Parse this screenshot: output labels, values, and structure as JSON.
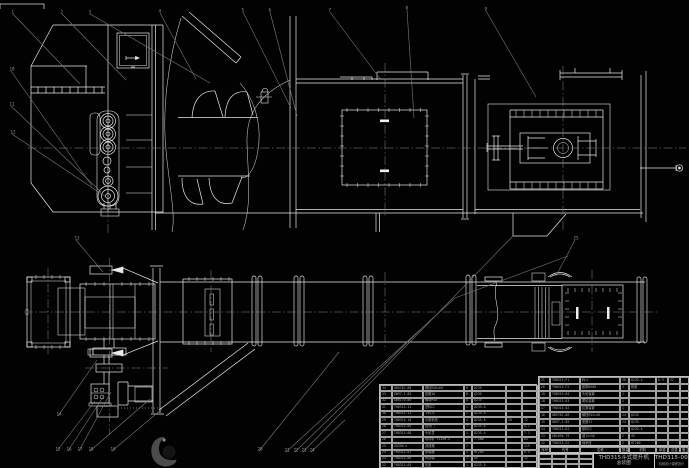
{
  "meta": {
    "background": "#020202",
    "line_color": "#e8e8e8",
    "leader_color": "#7a7a7a",
    "table_text_color": "#a9a9a9"
  },
  "title_block": {
    "product": "THD315斗式提升机",
    "sheet_name": "总装图",
    "drawing_no": "THD315-00",
    "org": "机械设计课程设计"
  },
  "bom_headers": [
    "序号",
    "代号",
    "名称",
    "数量",
    "材料",
    "单重",
    "总重",
    "备注"
  ],
  "right_bom_rows": [
    [
      "21",
      "THD315-F1",
      "料斗",
      "36",
      "Q235-A",
      "0.9",
      "32",
      ""
    ],
    [
      "20",
      "THD315-F2",
      "胶带B500",
      "1",
      "橡胶",
      "",
      "",
      ""
    ],
    [
      "19",
      "THD315-04",
      "头轮装置",
      "1",
      "",
      "",
      "",
      ""
    ],
    [
      "18",
      "THD315-03",
      "尾轮装置",
      "1",
      "",
      "",
      "",
      ""
    ],
    [
      "17",
      "THD315-02",
      "拉紧装置",
      "1",
      "",
      "",
      "",
      ""
    ],
    [
      "16",
      "GB5782-86",
      "螺栓M12×40",
      "24",
      "Q235",
      "",
      "",
      ""
    ],
    [
      "15",
      "GB97.1-85",
      "垫圈12",
      "24",
      "Q235",
      "",
      "",
      ""
    ],
    [
      "14",
      "THD315-01",
      "卸料口",
      "1",
      "Q235-A",
      "",
      "",
      ""
    ],
    [
      "13",
      "GB1096-79",
      "键12×56",
      "2",
      "45",
      "",
      "",
      ""
    ],
    [
      "12",
      "THD315-G2",
      "轴承座",
      "2",
      "HT200",
      "",
      "",
      ""
    ]
  ],
  "left_bom_rows": [
    [
      "34",
      "GB5782-86",
      "螺栓M16×60",
      "8",
      "Q235",
      "",
      ""
    ],
    [
      "33",
      "GB97.1-85",
      "垫圈16",
      "8",
      "Q235",
      "",
      ""
    ],
    [
      "32",
      "GB6170-86",
      "螺母M16",
      "8",
      "Q235",
      "",
      ""
    ],
    [
      "31",
      "THD315-12",
      "进料口",
      "1",
      "Q235-A",
      "",
      ""
    ],
    [
      "30",
      "THD315-11",
      "下料斗",
      "1",
      "Q235-A",
      "",
      ""
    ],
    [
      "29",
      "THD315-10",
      "中部机壳",
      "4",
      "Q235-A",
      "18",
      "72"
    ],
    [
      "28",
      "THD315-09",
      "检视门",
      "1",
      "Q235-A",
      "",
      "4.1"
    ],
    [
      "27",
      "THD315-08",
      "头轮罩",
      "1",
      "Q235-A",
      "",
      "7.2"
    ],
    [
      "26",
      "",
      "电动机 Y132M-4",
      "1",
      "7.5kW",
      "",
      "63"
    ],
    [
      "25",
      "ZQ350-Ⅱ",
      "减速器",
      "1",
      "",
      "",
      "115"
    ],
    [
      "24",
      "THD315-07",
      "联轴器",
      "1",
      "HT200",
      "",
      "6.4"
    ],
    [
      "23",
      "THD315-06",
      "传动轴",
      "1",
      "45",
      "",
      "12"
    ],
    [
      "22",
      "THD315-05",
      "机座",
      "1",
      "Q235-A",
      "",
      ""
    ]
  ],
  "callouts": [
    {
      "n": "1",
      "x": 13,
      "y": 12,
      "tx": 80,
      "ty": 84
    },
    {
      "n": "2",
      "x": 62,
      "y": 12,
      "tx": 126,
      "ty": 80
    },
    {
      "n": "3",
      "x": 90,
      "y": 12,
      "tx": 210,
      "ty": 83
    },
    {
      "n": "4",
      "x": 160,
      "y": 11,
      "tx": 196,
      "ty": 79
    },
    {
      "n": "5",
      "x": 243,
      "y": 10,
      "tx": 291,
      "ty": 108
    },
    {
      "n": "6",
      "x": 270,
      "y": 10,
      "tx": 297,
      "ty": 116
    },
    {
      "n": "7",
      "x": 330,
      "y": 10,
      "tx": 381,
      "ty": 80
    },
    {
      "n": "8",
      "x": 407,
      "y": 8,
      "tx": 414,
      "ty": 118
    },
    {
      "n": "9",
      "x": 486,
      "y": 9,
      "tx": 536,
      "ty": 97
    },
    {
      "n": "10",
      "x": 11,
      "y": 69,
      "tx": 92,
      "ty": 186
    },
    {
      "n": "11",
      "x": 11,
      "y": 104,
      "tx": 101,
      "ty": 192
    },
    {
      "n": "12",
      "x": 12,
      "y": 132,
      "tx": 106,
      "ty": 197
    },
    {
      "n": "13",
      "x": 76,
      "y": 238,
      "tx": 103,
      "ty": 272
    },
    {
      "n": "14",
      "x": 58,
      "y": 414,
      "tx": 97,
      "ty": 360
    },
    {
      "n": "15",
      "x": 57,
      "y": 449,
      "tx": 95,
      "ty": 401
    },
    {
      "n": "16",
      "x": 68,
      "y": 449,
      "tx": 103,
      "ty": 397
    },
    {
      "n": "17",
      "x": 79,
      "y": 449,
      "tx": 111,
      "ty": 392
    },
    {
      "n": "18",
      "x": 90,
      "y": 449,
      "tx": 150,
      "ty": 399
    },
    {
      "n": "19",
      "x": 112,
      "y": 449,
      "tx": 162,
      "ty": 409
    },
    {
      "n": "20",
      "x": 259,
      "y": 449,
      "tx": 339,
      "ty": 352
    },
    {
      "n": "21",
      "x": 286,
      "y": 450,
      "tx": 455,
      "ty": 298
    },
    {
      "n": "22",
      "x": 295,
      "y": 450,
      "tx": 420,
      "ty": 330
    },
    {
      "n": "23",
      "x": 303,
      "y": 450,
      "tx": 513,
      "ty": 236
    },
    {
      "n": "24",
      "x": 311,
      "y": 450,
      "tx": 345,
      "ty": 420
    },
    {
      "n": "25",
      "x": 575,
      "y": 238,
      "tx": 556,
      "ty": 276
    }
  ]
}
